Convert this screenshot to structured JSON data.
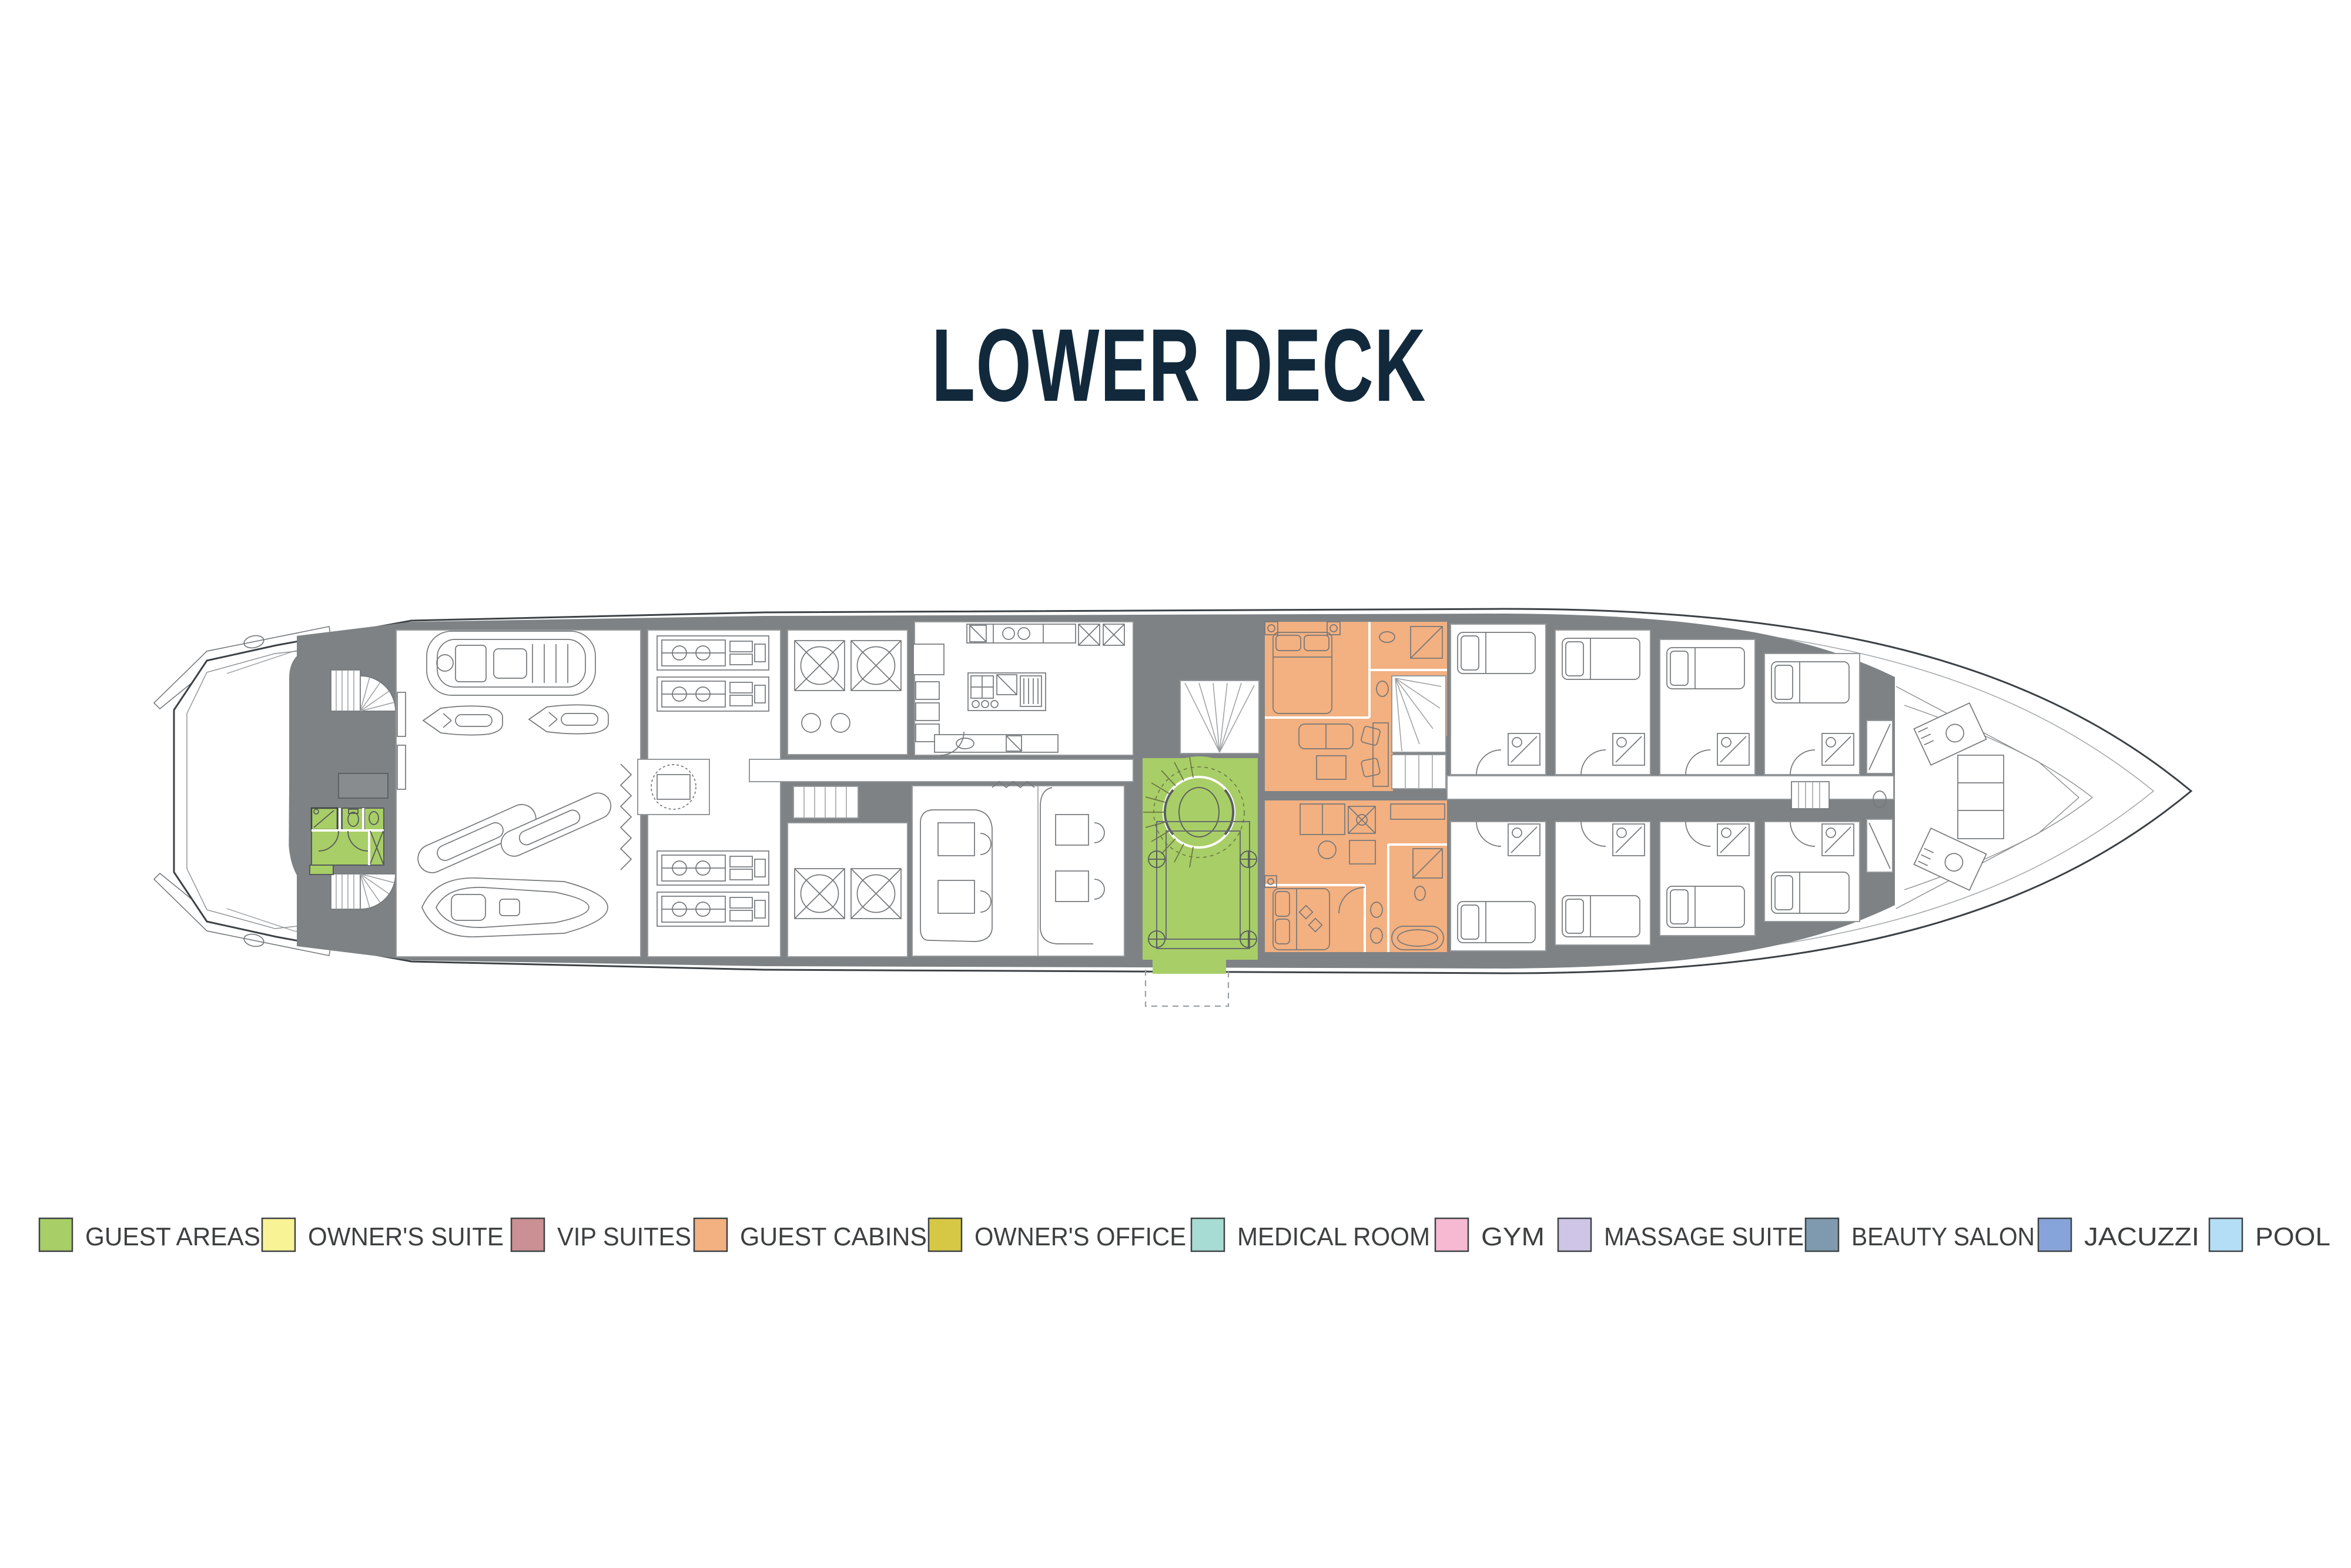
{
  "title": "LOWER DECK",
  "title_color": "#12293c",
  "legend": {
    "items": [
      {
        "name": "guest-areas",
        "label": "GUEST AREAS",
        "color": "#a8ce67"
      },
      {
        "name": "owners-suite",
        "label": "OWNER'S SUITE",
        "color": "#f8f394"
      },
      {
        "name": "vip-suites",
        "label": "VIP SUITES",
        "color": "#ca9093"
      },
      {
        "name": "guest-cabins",
        "label": "GUEST CABINS",
        "color": "#f3b080"
      },
      {
        "name": "owners-office",
        "label": "OWNER'S OFFICE",
        "color": "#d6c845"
      },
      {
        "name": "medical-room",
        "label": "MEDICAL ROOM",
        "color": "#a6dcd3"
      },
      {
        "name": "gym",
        "label": "GYM",
        "color": "#f6b9d1"
      },
      {
        "name": "massage-suite",
        "label": "MASSAGE SUITE",
        "color": "#cfc5e6"
      },
      {
        "name": "beauty-salon",
        "label": "BEAUTY SALON",
        "color": "#7f9aae"
      },
      {
        "name": "jacuzzi",
        "label": "JACUZZI",
        "color": "#87a4da"
      },
      {
        "name": "pool",
        "label": "POOL",
        "color": "#b4def5"
      }
    ]
  },
  "plan": {
    "deck": "LOWER DECK",
    "colors": {
      "walls": "#7e8285",
      "teak": "#e9dbc2",
      "teak_line": "#cfbfa2",
      "guest_areas": "#a8ce67",
      "guest_cabins": "#f3b080"
    },
    "highlighted_areas": [
      {
        "name": "stern-day-head",
        "category": "GUEST AREAS",
        "color": "#a8ce67"
      },
      {
        "name": "lobby-spiral-staircase",
        "category": "GUEST AREAS",
        "color": "#a8ce67"
      },
      {
        "name": "guest-cabin-starboard",
        "category": "GUEST CABINS",
        "color": "#f3b080"
      },
      {
        "name": "guest-cabin-port",
        "category": "GUEST CABINS",
        "color": "#f3b080"
      }
    ]
  }
}
